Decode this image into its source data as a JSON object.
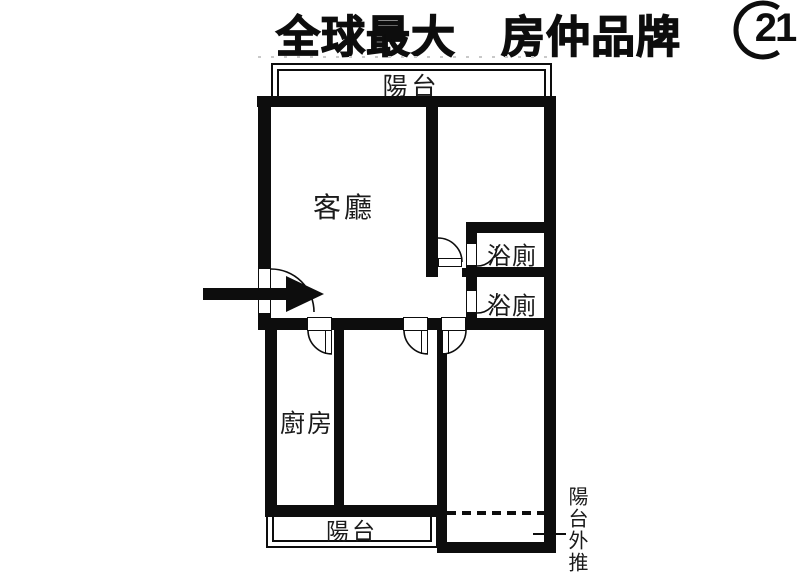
{
  "header": {
    "title": "全球最大　房仲品牌",
    "logo_text": "21"
  },
  "floorplan": {
    "rooms": {
      "balcony_top": "陽台",
      "living_room": "客廳",
      "bathroom_upper": "浴廁",
      "bathroom_lower": "浴廁",
      "kitchen": "廚房",
      "balcony_bottom": "陽台"
    },
    "annotation": {
      "balcony_pushout": "陽台外推"
    }
  },
  "colors": {
    "line": "#0d0d0d",
    "background": "#ffffff"
  }
}
